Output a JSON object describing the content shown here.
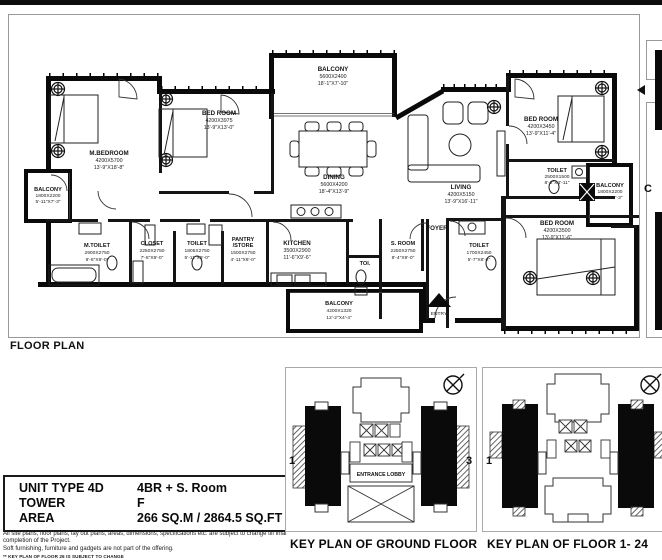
{
  "page": {
    "section_label": "FLOOR PLAN"
  },
  "plan": {
    "rooms": [
      {
        "name": "M.BEDROOM",
        "mm": "4200X5700",
        "ft": "13'-9\"X18'-8\""
      },
      {
        "name": "BED ROOM",
        "mm": "4200X3975",
        "ft": "13'-9\"X13'-0\""
      },
      {
        "name": "BALCONY",
        "mm": "5600X2400",
        "ft": "18'-1\"X7'-10\""
      },
      {
        "name": "DINING",
        "mm": "5600X4200",
        "ft": "18'-4\"X13'-9\""
      },
      {
        "name": "LIVING",
        "mm": "4200X5150",
        "ft": "13'-9\"X16'-11\""
      },
      {
        "name": "BED ROOM",
        "mm": "4200X3450",
        "ft": "13'-9\"X11'-4\""
      },
      {
        "name": "TOILET",
        "mm": "2500X1500",
        "ft": "8'-2\"X4'-11\""
      },
      {
        "name": "BALCONY",
        "mm": "1800X2200",
        "ft": "5'-11\"X7'-3\""
      },
      {
        "name": "BED ROOM",
        "mm": "4200X3500",
        "ft": "13'-9\"X11'-6\""
      },
      {
        "name": "TOILET",
        "mm": "1700X2450",
        "ft": "5'-7\"X8'-2\""
      },
      {
        "name": "S. ROOM",
        "mm": "2250X2750",
        "ft": "8'-4\"X9'-0\""
      },
      {
        "name": "KITCHEN",
        "mm": "3500X2900",
        "ft": "11'-6\"X9'-6\""
      },
      {
        "name": "BALCONY",
        "mm": "4200X1320",
        "ft": "12'-2\"X4'-4\""
      },
      {
        "name": "PANTRY",
        "name2": "/STORE",
        "mm": "1500X2750",
        "ft": "4'-11\"X9'-0\""
      },
      {
        "name": "TOILET",
        "mm": "1805X2750",
        "ft": "5'-11\"X9'-0\""
      },
      {
        "name": "CLOSET",
        "mm": "2250X2750",
        "ft": "7'-5\"X9'-0\""
      },
      {
        "name": "M.TOILET",
        "mm": "2900X2750",
        "ft": "9'-6\"X9'-0\""
      },
      {
        "name": "BALCONY",
        "mm": "1800X2200",
        "ft": "5'-11\"X7'-3\""
      }
    ],
    "labels": {
      "foyer": "FOYER",
      "entry": "ENTRY",
      "toi": "TOI."
    },
    "partial_text": "C"
  },
  "unit_info": {
    "rows": [
      {
        "label": "UNIT TYPE 4D",
        "value": "4BR + S. Room"
      },
      {
        "label": "TOWER",
        "value": "F"
      },
      {
        "label": "AREA",
        "value": "266 SQ.M  /  2864.5 SQ.FT"
      }
    ]
  },
  "disclaimer": {
    "line1": "All site plans, floor plans, lay out plans, areas, dimensions, specifications etc. are subject to change till final completion of the Project.",
    "line2": "Soft furnishing, furniture and gadgets are not part of the offering.",
    "line3": "** KEY PLAN OF FLOOR 26 IS SUBJECT TO CHANGE"
  },
  "key_plans": [
    {
      "caption": "KEY PLAN OF GROUND FLOOR",
      "left_num": "1",
      "right_num": "3",
      "lobby": "ENTRANCE LOBBY"
    },
    {
      "caption": "KEY PLAN OF FLOOR 1- 24",
      "left_num": "1",
      "right_num": "3"
    }
  ]
}
